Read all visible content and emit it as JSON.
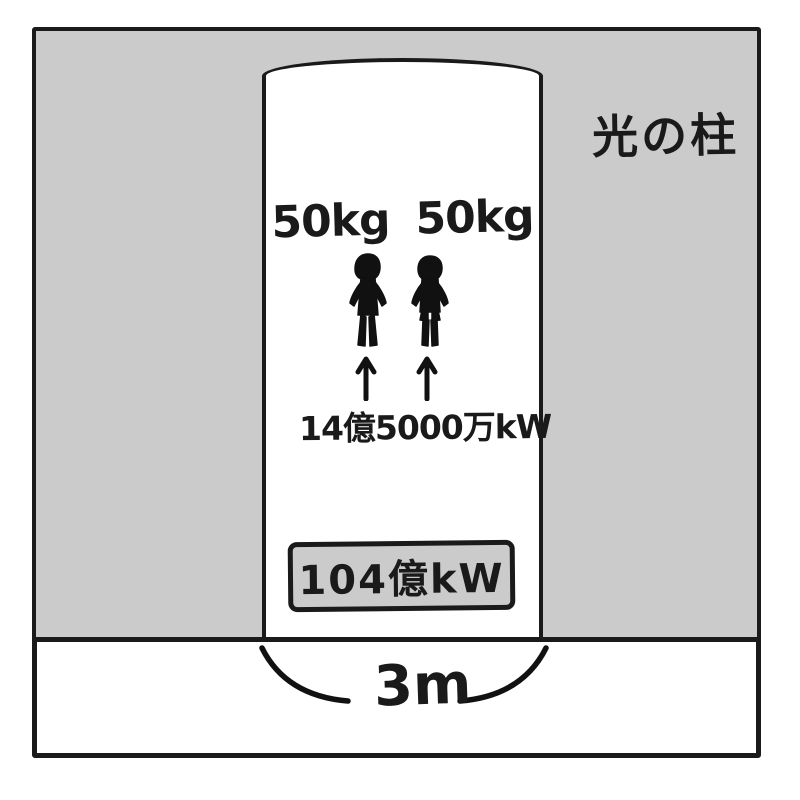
{
  "scene": {
    "pillar_title": "光の柱",
    "weight_left": "50kg",
    "weight_right": "50kg",
    "per_person_power": "14億5000万kW",
    "total_power": "104億kW",
    "pillar_width": "3m"
  },
  "icons": {
    "figure_left": "person-silhouette-icon",
    "figure_right": "person-silhouette-icon",
    "arrow_left": "up-arrow-icon",
    "arrow_right": "up-arrow-icon",
    "brace": "width-brace-icon"
  },
  "colors": {
    "ink": "#1a1a1a",
    "gray": "#cbcbcb",
    "paper": "#ffffff"
  }
}
